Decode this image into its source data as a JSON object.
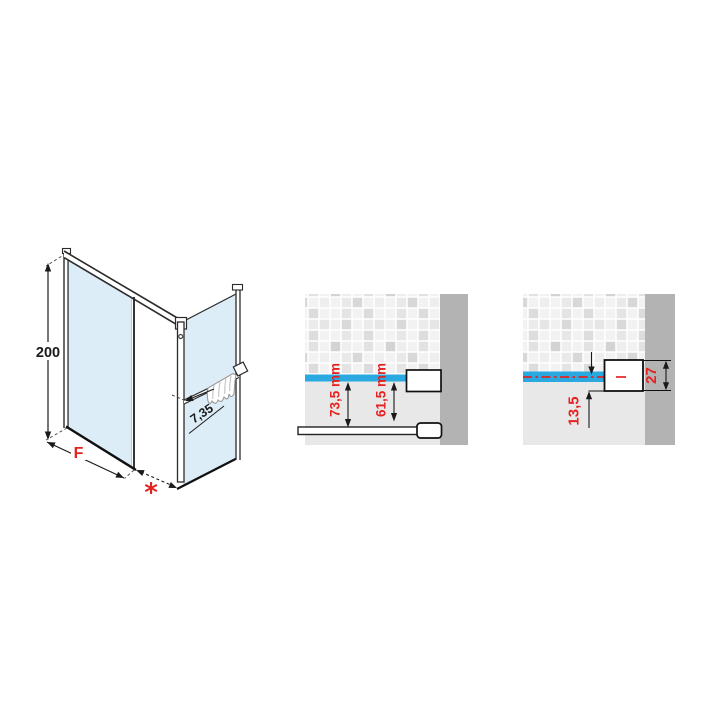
{
  "iso": {
    "height": "200",
    "fixed_panel_width": "F",
    "opening": "*",
    "corner_gap": "7,35"
  },
  "detail_mid": {
    "dim_outer": "73,5 mm",
    "dim_inner": "61,5 mm"
  },
  "detail_right": {
    "dim_axis_offset": "13,5",
    "dim_profile": "27"
  },
  "colors": {
    "dimension_red": "#e42320",
    "glass_blue_light": "#dcedf8",
    "glass_bar_blue": "#29a9e0",
    "wall_section_gray": "#b3b3b3",
    "wall_plain_gray": "#e8e8e8",
    "line_dark": "#1a1a1a"
  }
}
